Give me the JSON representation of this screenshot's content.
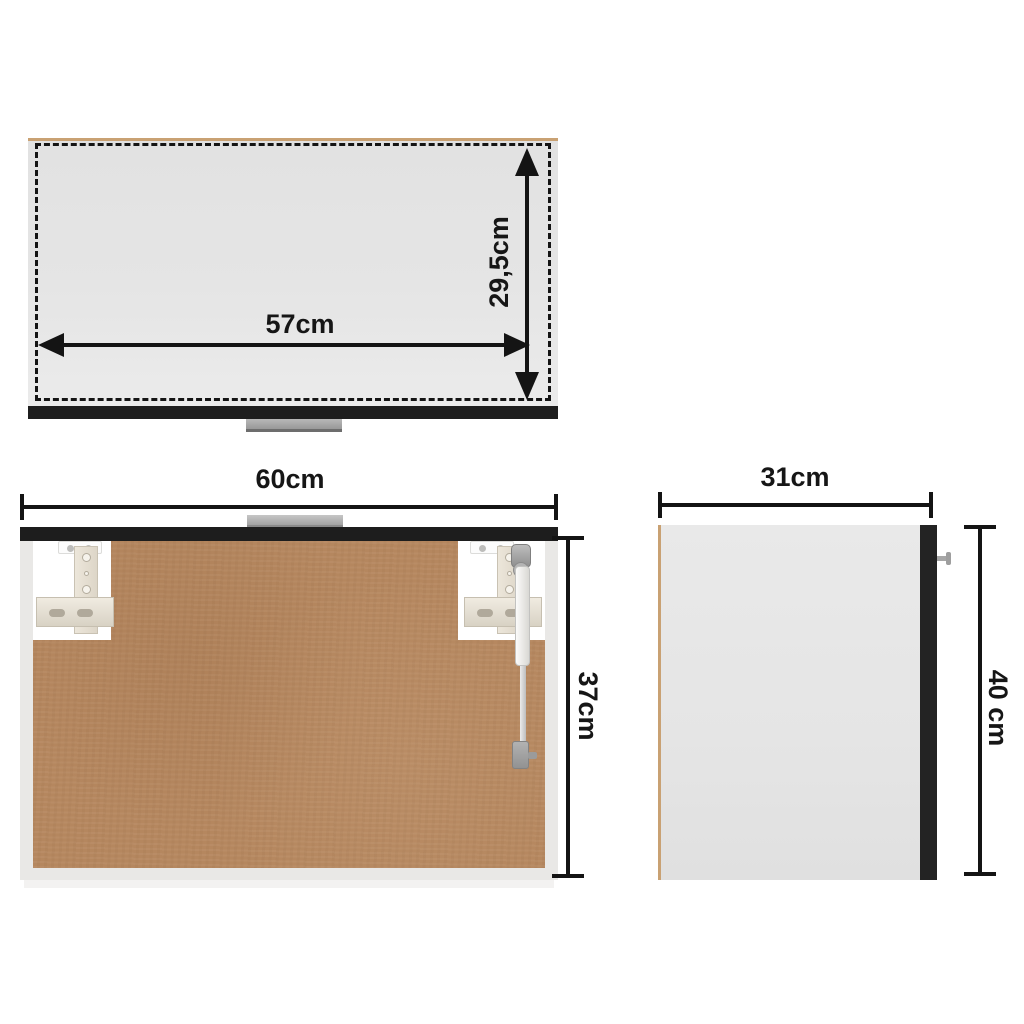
{
  "figure": {
    "type": "product-dimension-diagram",
    "front_view": {
      "width_label": "57cm",
      "height_label": "29,5cm"
    },
    "open_view": {
      "width_label": "60cm",
      "height_label": "37cm"
    },
    "side_view": {
      "width_label": "31cm",
      "height_label": "40 cm"
    },
    "colors": {
      "dimension_ink": "#141414",
      "wood_edge": "#c9a173",
      "back_panel_brown": "#b5875f",
      "trim_black": "#1e1e1e",
      "face_gray": "#e4e4e4",
      "handle_gray": "#a4a4a4"
    }
  }
}
